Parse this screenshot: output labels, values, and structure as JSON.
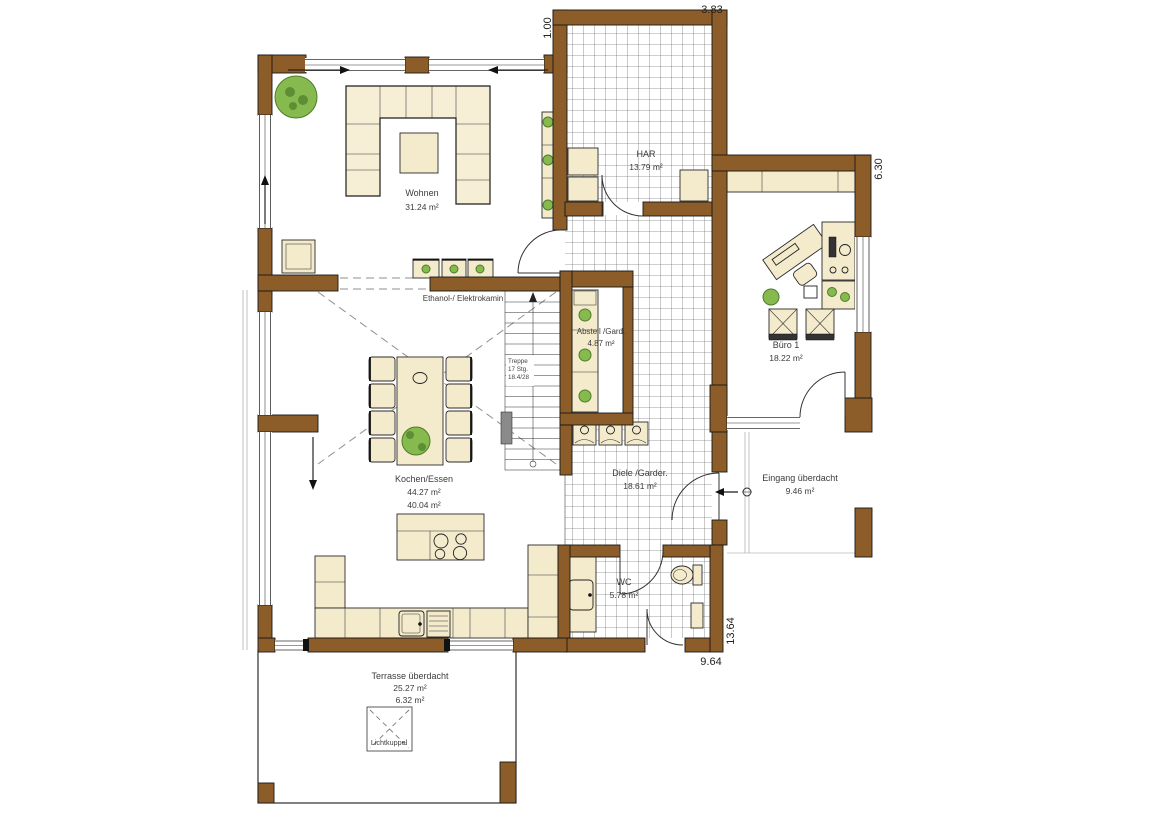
{
  "colors": {
    "wall_brown": "#8c5d28",
    "furniture_beige": "#f4ebcd",
    "plant_green": "#86b94e",
    "tile_line": "#3f3f3f",
    "label_text": "#3c3c3c"
  },
  "rooms": {
    "wohnen": {
      "name": "Wohnen",
      "area": "31.24 m²"
    },
    "har": {
      "name": "HAR",
      "area": "13.79 m²"
    },
    "buero": {
      "name": "Büro 1",
      "area": "18.22 m²"
    },
    "abstell": {
      "name": "Abstell /Gard.",
      "area": "4.87 m²"
    },
    "diele": {
      "name": "Diele /Garder.",
      "area": "18.61 m²"
    },
    "kochen": {
      "name": "Kochen/Essen",
      "area": "44.27 m²",
      "area2": "40.04 m²"
    },
    "wc": {
      "name": "WC",
      "area": "5.78 m²"
    },
    "eingang": {
      "name": "Eingang überdacht",
      "area": "9.46 m²"
    },
    "terrasse": {
      "name": "Terrasse überdacht",
      "area": "25.27 m²",
      "area2": "6.32 m²"
    }
  },
  "annotations": {
    "kamin": "Ethanol-/ Elektrokamin",
    "lichtkuppel": "Lichtkuppel",
    "treppe_1": "Treppe",
    "treppe_2": "17 Stg.",
    "treppe_3": "18.4/28"
  },
  "dimensions": {
    "top": "3.83",
    "top_inner": "1.00",
    "right_upper": "6.30",
    "right_lower": "13.64",
    "bottom": "9.64"
  }
}
